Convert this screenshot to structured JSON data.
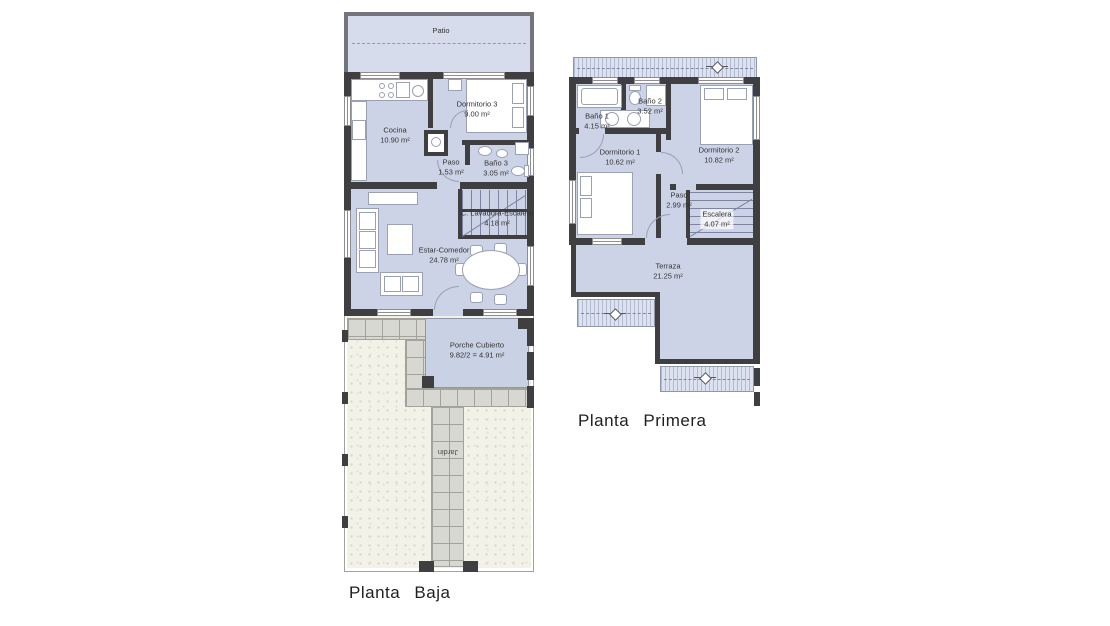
{
  "colors": {
    "room_fill": "#ccd3e6",
    "patio_fill": "#d6dcec",
    "porch_fill": "#c9d1e4",
    "wall_dark": "#3f3f41",
    "wall_medium": "#74757c",
    "roof_hatch_fill": "#dde2f0",
    "tile_fill": "#d8d8d2",
    "garden_fill": "#f3f2e9",
    "text": "#333333"
  },
  "plans": {
    "planta_baja": {
      "title": "Planta Baja",
      "rooms": {
        "patio": {
          "name": "Patio"
        },
        "cocina": {
          "name": "Cocina",
          "area": "10.90 m²"
        },
        "dormitorio3": {
          "name": "Dormitorio 3",
          "area": "9.00 m²"
        },
        "paso": {
          "name": "Paso",
          "area": "1.53 m²"
        },
        "bano3": {
          "name": "Baño 3",
          "area": "3.05 m²"
        },
        "lavadora_escalera": {
          "name": "C. Lavadora-Escalera",
          "area": "4.18 m²"
        },
        "estar_comedor": {
          "name": "Estar-Comedor",
          "area": "24.78 m²"
        },
        "porche": {
          "name": "Porche Cubierto",
          "area": "9.82/2 = 4.91 m²"
        },
        "jardin": {
          "name": "Jardin"
        }
      }
    },
    "planta_primera": {
      "title": "Planta Primera",
      "rooms": {
        "bano1": {
          "name": "Baño 1",
          "area": "4.15 m²"
        },
        "bano2": {
          "name": "Baño 2",
          "area": "3.52 m²"
        },
        "dormitorio1": {
          "name": "Dormitorio 1",
          "area": "10.62 m²"
        },
        "dormitorio2": {
          "name": "Dormitorio 2",
          "area": "10.82 m²"
        },
        "paso": {
          "name": "Paso",
          "area": "2.99 m²"
        },
        "escalera": {
          "name": "Escalera",
          "area": "4.07 m²"
        },
        "terraza": {
          "name": "Terraza",
          "area": "21.25 m²"
        }
      }
    }
  }
}
